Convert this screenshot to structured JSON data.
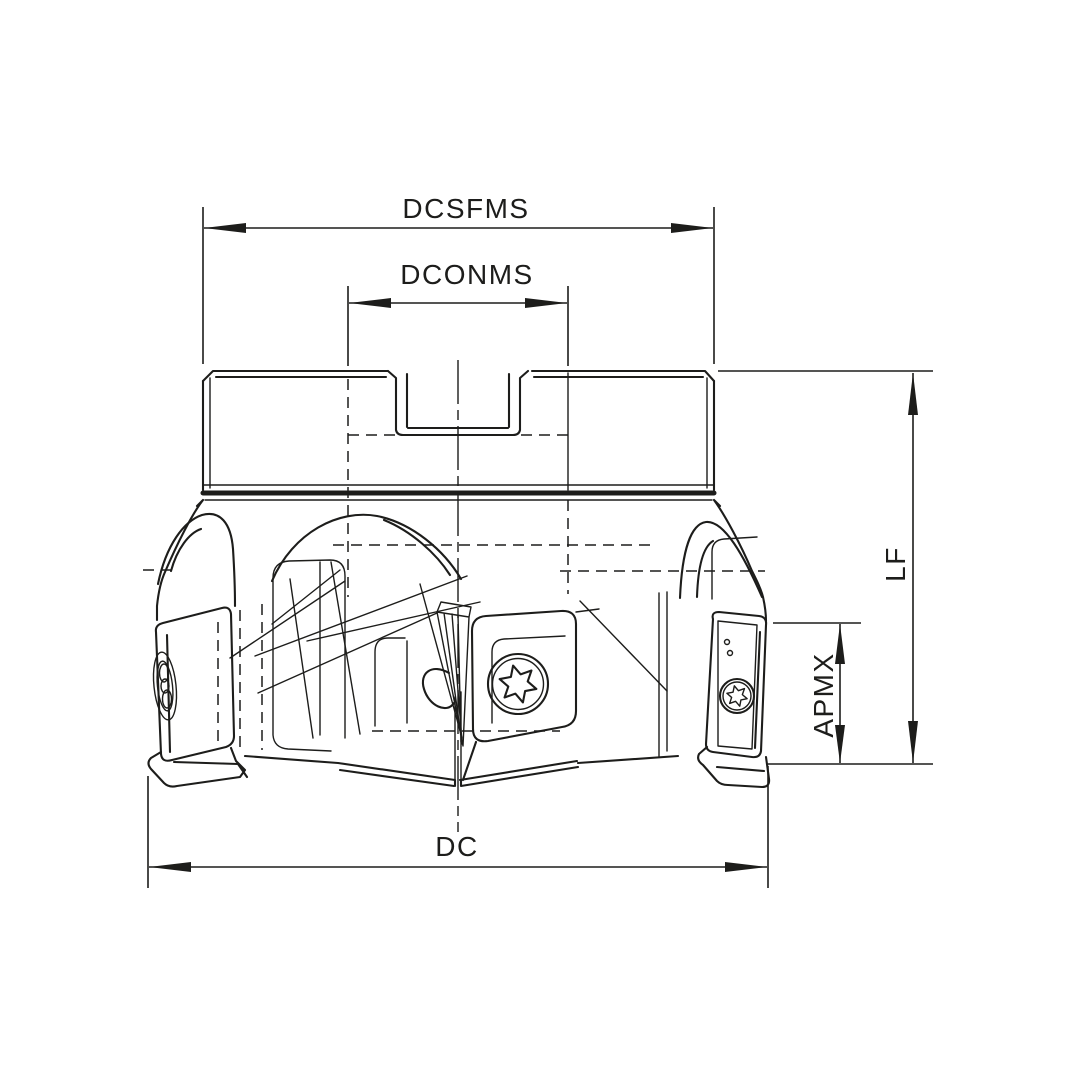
{
  "figure": {
    "type": "technical-line-drawing",
    "subject": "Indexable-insert face milling cutter, side elevation with dimension callouts",
    "background_color": "#ffffff",
    "line_color": "#1d1d1b"
  },
  "dimensions": [
    {
      "id": "dcsfms",
      "label": "DCSFMS",
      "orientation": "horizontal",
      "position": "top-outer",
      "measures": "shank outer diameter"
    },
    {
      "id": "dconms",
      "label": "DCONMS",
      "orientation": "horizontal",
      "position": "top-inner",
      "measures": "connection bore diameter"
    },
    {
      "id": "lf",
      "label": "LF",
      "orientation": "vertical",
      "position": "right-outer",
      "measures": "functional length"
    },
    {
      "id": "apmx",
      "label": "APMX",
      "orientation": "vertical",
      "position": "right-inner",
      "measures": "maximum depth of cut"
    },
    {
      "id": "dc",
      "label": "DC",
      "orientation": "horizontal",
      "position": "bottom",
      "measures": "cutting diameter"
    }
  ]
}
